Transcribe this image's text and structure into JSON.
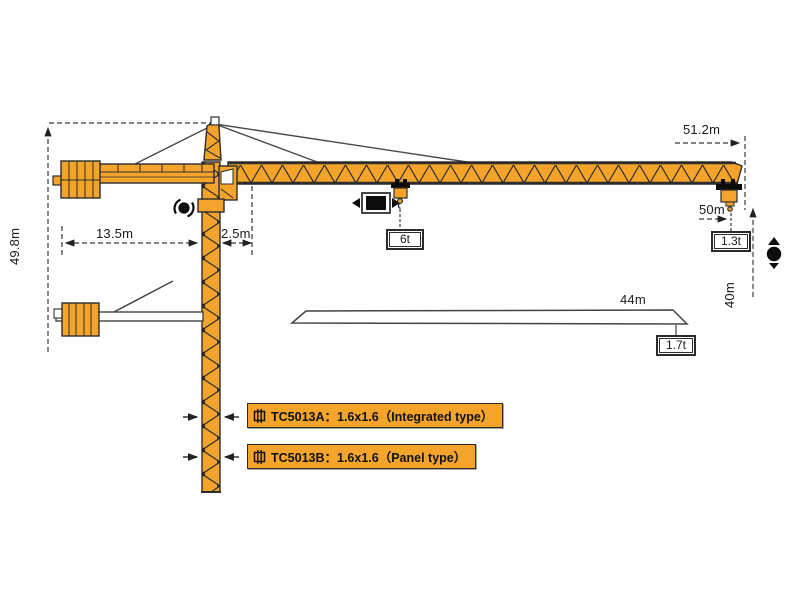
{
  "diagram": {
    "subject": "tower crane working range diagram",
    "colors": {
      "crane_orange": "#F5A42B",
      "outline": "#2D2D2D",
      "dimension_line": "#3A3A3A",
      "background": "#FFFFFF"
    }
  },
  "dimensions": {
    "total_height": "49.8m",
    "counterjib_radius": "13.5m",
    "tower_offset": "2.5m",
    "max_radius": "51.2m",
    "hook_radius": "50m",
    "hook_height": "40m",
    "mid_radius": "44m"
  },
  "loads": {
    "max_load": "6t",
    "tip_load": "1.3t",
    "load_at_44m": "1.7t"
  },
  "models": [
    {
      "label": "TC5013A：1.6x1.6（Integrated type）"
    },
    {
      "label": "TC5013B：1.6x1.6（Panel type）"
    }
  ],
  "icons": {
    "rotation-icon": "slewing ● with curved arrows",
    "trolley-travel-icon": "◄ ■ ►",
    "hoist-icon": "▲ ● ▼",
    "mast-section-icon": "mast cross-section symbol"
  }
}
